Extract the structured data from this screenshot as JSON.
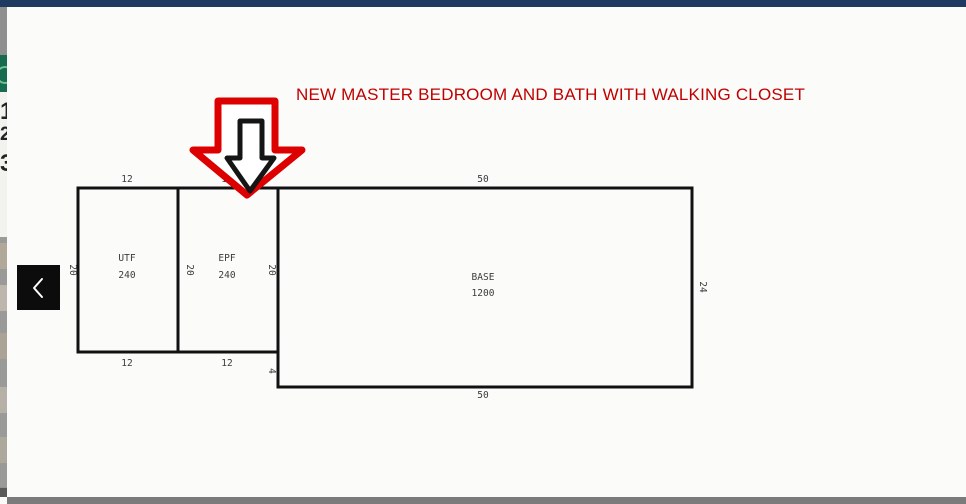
{
  "viewer": {
    "back_button": {
      "icon": "chevron-left"
    },
    "annotation": {
      "title": "NEW MASTER BEDROOM AND BATH WITH WALKING CLOSET",
      "arrows": [
        "red-down-block-arrow",
        "black-down-block-arrow"
      ]
    },
    "sketch": {
      "areas": [
        {
          "code": "UTF",
          "sqft": "240"
        },
        {
          "code": "EPF",
          "sqft": "240"
        },
        {
          "code": "BASE",
          "sqft": "1200"
        }
      ],
      "dims": {
        "utf_top": "12",
        "epf_top": "12",
        "base_top": "50",
        "utf_left": "20",
        "epf_left": "20",
        "epf_right": "20",
        "base_right": "24",
        "utf_bottom": "12",
        "epf_bottom": "12",
        "base_step": "4",
        "base_bottom": "50"
      }
    }
  },
  "background": {
    "fragments": [
      "1",
      "2",
      "3"
    ]
  },
  "colors": {
    "top_bar": "#1f3a60",
    "bottom_bar": "#7b7b7b",
    "annotation_red": "#c00000",
    "arrow_red": "#dd0000",
    "arrow_black": "#151515",
    "sketch_line": "#111111",
    "badge_green": "#176b4f"
  }
}
